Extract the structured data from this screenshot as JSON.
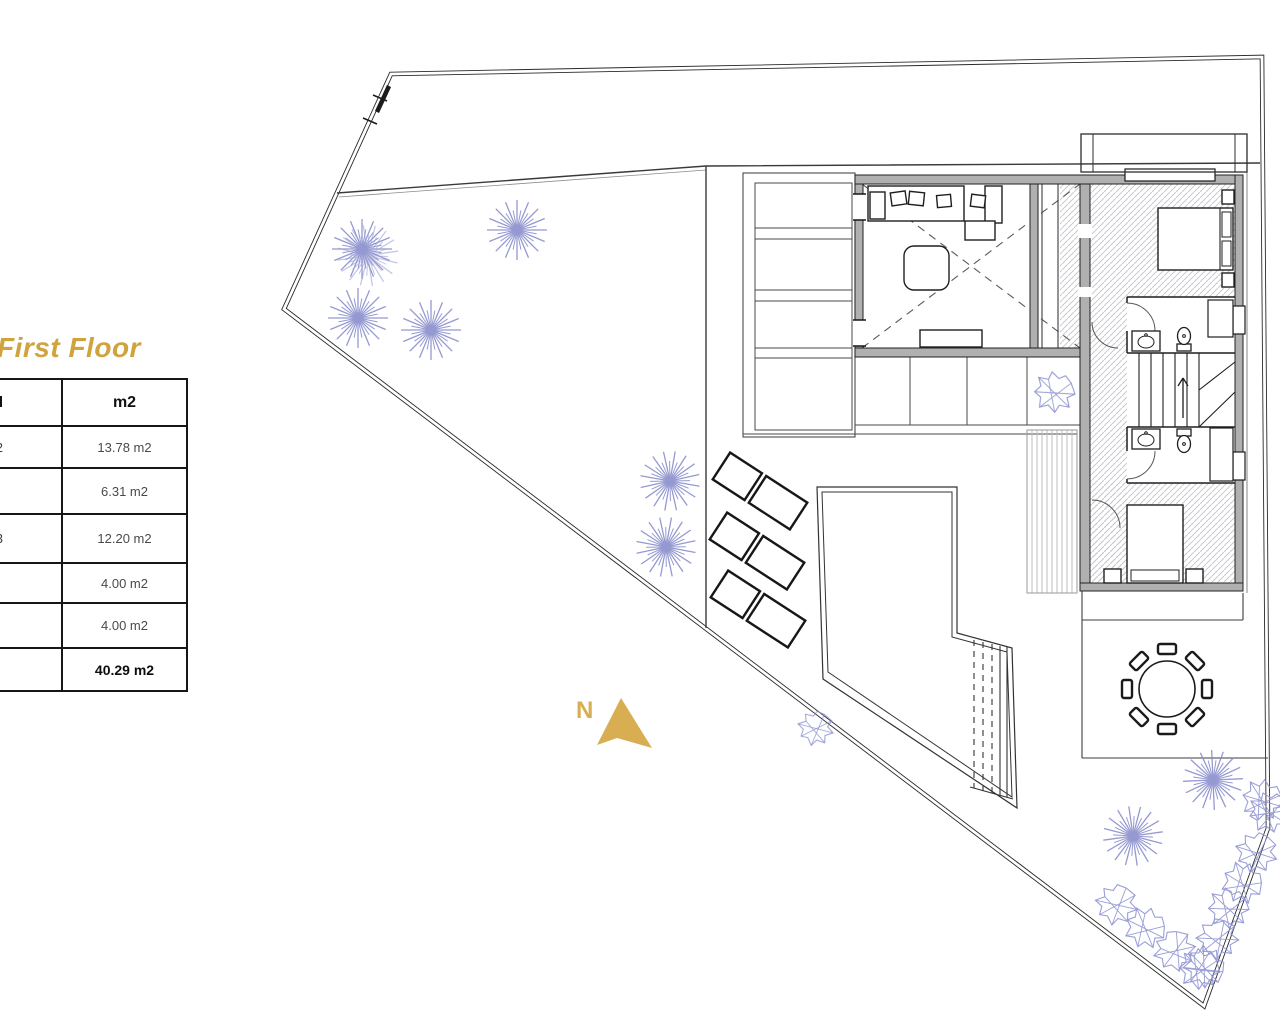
{
  "title": {
    "text": "First Floor",
    "color": "#d0a33e"
  },
  "area_table": {
    "header": {
      "name_fragment": "e útil",
      "area_label": "m2"
    },
    "rows": [
      {
        "name_fragment": "o 2",
        "area": "13.78 m2"
      },
      {
        "name_fragment": "",
        "area": "6.31 m2"
      },
      {
        "name_fragment": "o 3",
        "area": "12.20 m2"
      },
      {
        "name_fragment": "",
        "area": "4.00 m2"
      },
      {
        "name_fragment": "",
        "area": "4.00 m2"
      }
    ],
    "total": {
      "name_fragment": "",
      "area": "40.29 m2"
    }
  },
  "compass": {
    "label": "N",
    "color": "#d9ad52"
  },
  "colors": {
    "accent_gold": "#d0a33e",
    "vegetation_purple": "#8287c9",
    "wall_gray": "#b0b0b0",
    "line_dark": "#3c3c3c"
  }
}
